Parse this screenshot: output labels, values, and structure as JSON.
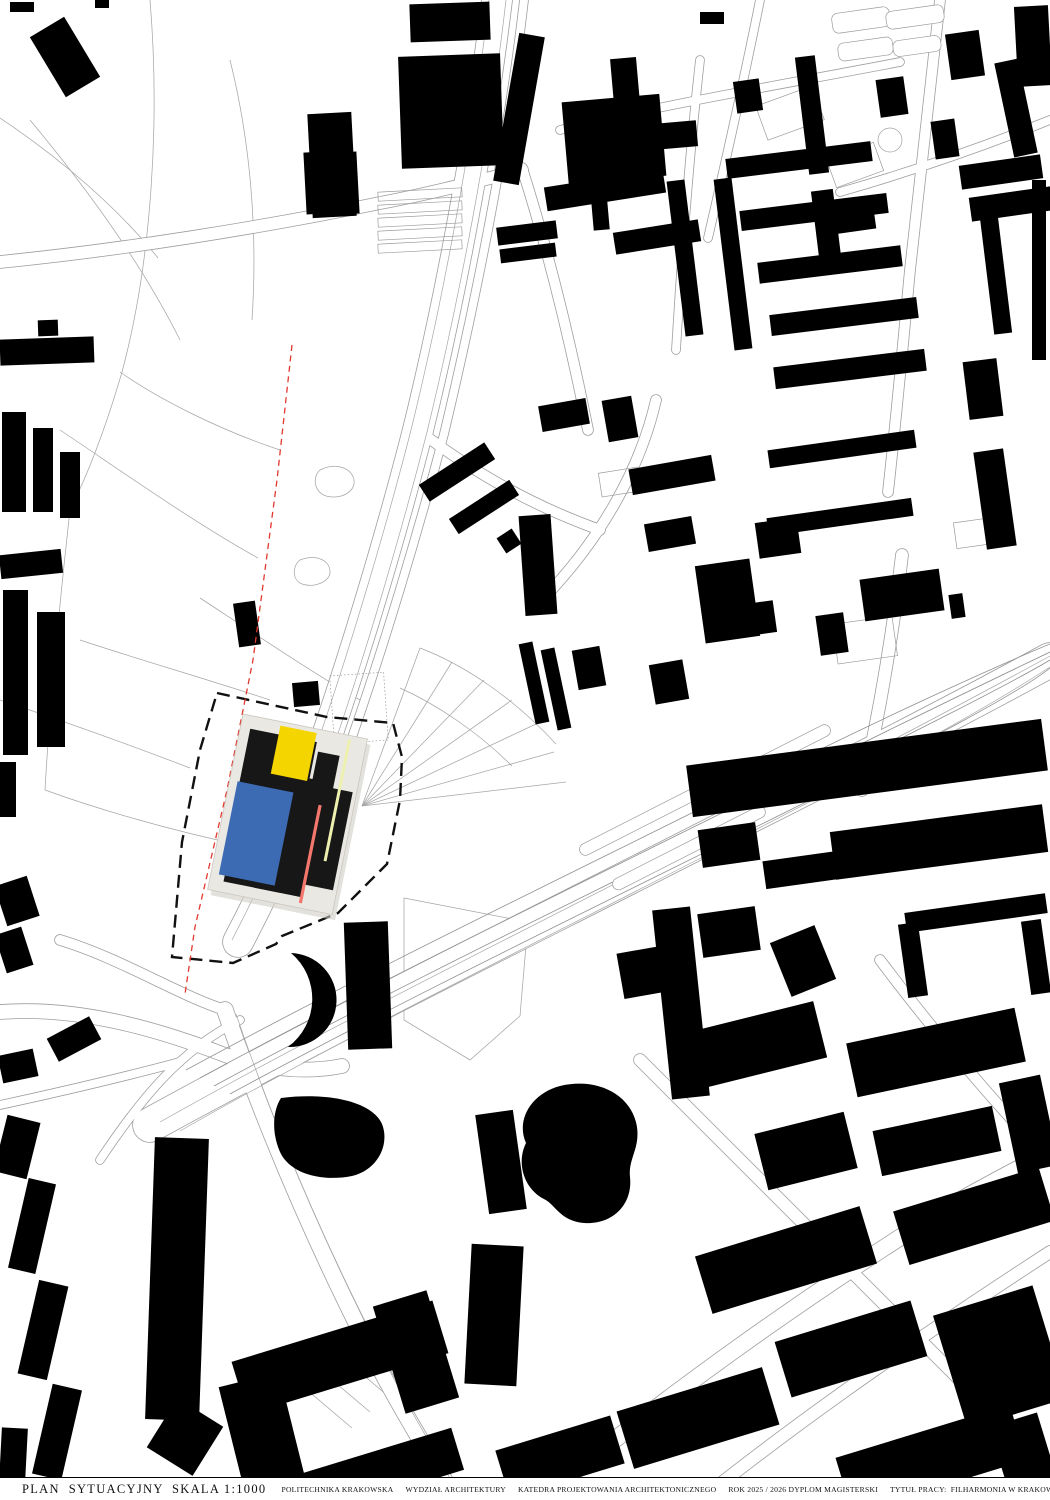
{
  "title_bar": {
    "title": "PLAN  SYTUACYJNY  SKALA 1:1000",
    "items": [
      "POLITECHNIKA KRAKOWSKA",
      "WYDZIAŁ ARCHITEKTURY",
      "KATEDRA PROJEKTOWANIA ARCHITEKTONICZNEGO",
      "ROK 2025 / 2026 DYPLOM MAGISTERSKI",
      "TYTUŁ PRACY:  FILHARMONIA W KRAKOWIE",
      "AUTOR: INŻ. ARCH. MONIKA SERAFIN",
      "PROMOTOR: DR INŻ. ARCH. PRZEMYSŁAW BIGAJ",
      "RECENZENT: DR INŻ. ARCH. JAN ŁAŚ, PROF. PK"
    ]
  },
  "colors": {
    "background": "#ffffff",
    "buildings": "#000000",
    "road_casing": "#9e9e9e",
    "road_fill": "#ffffff",
    "thin_line": "#a6a6a6",
    "rail_line": "#8f8f8f",
    "parcel_line": "#9a9a9a",
    "site_boundary": "#111111",
    "red_line": "#e2382f",
    "panel": "#eae8e2",
    "panel_edge": "#c9c7bf",
    "panel_shadow": "#cfcdc5",
    "black_mass": "#171717",
    "blue_block": "#3c6ab3",
    "yellow_block": "#f5d500",
    "pale_yellow_line": "#eef0b0",
    "salmon_line": "#f3776d"
  },
  "site": {
    "boundary": [
      [
        217,
        693
      ],
      [
        327,
        717
      ],
      [
        393,
        723
      ],
      [
        402,
        757
      ],
      [
        400,
        800
      ],
      [
        387,
        864
      ],
      [
        338,
        913
      ],
      [
        282,
        936
      ],
      [
        276,
        944
      ],
      [
        233,
        963
      ],
      [
        172,
        957
      ],
      [
        182,
        842
      ],
      [
        200,
        750
      ]
    ],
    "red_line": [
      [
        292,
        345
      ],
      [
        277,
        480
      ],
      [
        253,
        660
      ],
      [
        227,
        790
      ],
      [
        195,
        927
      ],
      [
        185,
        994
      ]
    ],
    "composition": {
      "origin": [
        243,
        714
      ],
      "rotation_deg": 11.4,
      "width": 127,
      "height": 179,
      "shapes": [
        {
          "name": "black-mass-upper",
          "x": 10,
          "y": 13,
          "w": 68,
          "h": 98,
          "fill": "black_mass"
        },
        {
          "name": "black-mass-right-top",
          "x": 81,
          "y": 22,
          "w": 22,
          "h": 50,
          "fill": "black_mass"
        },
        {
          "name": "black-mass-right",
          "x": 81,
          "y": 55,
          "w": 42,
          "h": 100,
          "fill": "black_mass"
        },
        {
          "name": "black-mass-center",
          "x": 45,
          "y": 50,
          "w": 48,
          "h": 118,
          "fill": "black_mass"
        },
        {
          "name": "black-mass-lower",
          "x": 14,
          "y": 138,
          "w": 58,
          "h": 30,
          "fill": "black_mass"
        },
        {
          "name": "blue-block",
          "x": 8,
          "y": 67,
          "w": 57,
          "h": 95,
          "fill": "blue_block"
        },
        {
          "name": "yellow-block",
          "x": 39,
          "y": 4,
          "w": 37,
          "h": 49,
          "fill": "yellow_block"
        },
        {
          "name": "pale-yellow-line",
          "x": 108,
          "y": 4,
          "w": 3,
          "h": 124,
          "fill": "pale_yellow_line"
        },
        {
          "name": "salmon-line",
          "x": 92,
          "y": 74,
          "w": 3.2,
          "h": 100,
          "fill": "salmon_line"
        }
      ]
    }
  },
  "map": {
    "roads": [
      {
        "d": "M497,0 C480,140 450,300 418,430 C395,520 360,640 322,750 C300,815 268,885 238,942",
        "w": 30
      },
      {
        "d": "M524,0 C508,140 476,300 444,434 C420,525 384,648 344,760",
        "w": 8
      },
      {
        "d": "M0,262 C120,250 260,228 380,203 C428,194 478,181 522,170",
        "w": 12
      },
      {
        "d": "M150,1125 C330,1026 530,928 710,836 C845,768 955,712 1050,660",
        "w": 34
      },
      {
        "d": "M225,1010 C258,1105 300,1208 350,1310 C390,1392 428,1452 456,1500",
        "w": 16
      },
      {
        "d": "M540,1500 C660,1400 800,1300 940,1212 C980,1188 1020,1168 1050,1152",
        "w": 16
      },
      {
        "d": "M700,1500 C810,1412 930,1330 1050,1252",
        "w": 12
      },
      {
        "d": "M640,1060 C760,1180 880,1300 1000,1420",
        "w": 12
      },
      {
        "d": "M880,960 C940,1040 1010,1120 1050,1160",
        "w": 10
      },
      {
        "d": "M902,555 C892,640 878,720 862,790",
        "w": 12
      },
      {
        "d": "M940,0 C930,90 920,180 910,270 C903,345 896,420 888,492",
        "w": 10
      },
      {
        "d": "M656,400 C640,470 600,540 542,600",
        "w": 10
      },
      {
        "d": "M522,168 C548,250 570,340 588,430",
        "w": 10
      },
      {
        "d": "M60,940 C120,958 180,996 225,1010",
        "w": 10
      },
      {
        "d": "M0,1012 C80,1006 160,1030 225,1055 C262,1068 302,1074 342,1066",
        "w": 14
      },
      {
        "d": "M100,1160 C140,1100 180,1050 240,1020",
        "w": 8
      },
      {
        "d": "M0,1105 C60,1092 120,1078 180,1062",
        "w": 8
      },
      {
        "d": "M700,60 C690,150 682,250 676,350",
        "w": 8
      },
      {
        "d": "M560,130 C660,105 780,85 900,62",
        "w": 8
      },
      {
        "d": "M1050,120 C980,148 910,172 840,192",
        "w": 8
      },
      {
        "d": "M760,0 C744,80 726,160 708,238",
        "w": 8
      },
      {
        "d": "M418,430 C470,470 530,505 600,530",
        "w": 10
      }
    ],
    "lane_lines": [
      "M489,0 C473,140 443,300 411,430 C388,520 353,640 315,750 C293,815 262,882 232,940",
      "M506,0 C490,140 459,300 427,432 C404,522 369,644 331,754",
      "M160,1122 C330,1026 530,928 710,835 C840,768 955,708 1050,656",
      "M180,1131 C350,1034 550,936 728,844 C862,775 975,716 1050,667",
      "M236,1014 C268,1108 310,1210 360,1312 C398,1392 436,1452 462,1500"
    ],
    "rails": [
      "M200,1078 C380,980 580,884 760,794 C900,724 1000,676 1050,652",
      "M214,1086 C394,988 594,892 774,802 C914,732 1010,684 1050,660",
      "M230,1094 C410,996 610,900 790,810 C930,740 1020,692 1050,668",
      "M186,1070 C366,972 566,876 746,786 C886,716 992,668 1050,644"
    ],
    "park_lines": [
      "M150,0 C160,120 152,260 122,372 C108,420 90,470 70,510",
      "M0,118 C60,158 118,208 158,258",
      "M60,430 C120,470 190,520 258,558",
      "M200,598 C258,636 318,676 360,700",
      "M0,700 C60,720 130,745 190,768",
      "M70,510 C60,600 50,700 45,790",
      "M120,372 C160,400 220,430 280,450",
      "M30,120 C80,180 140,260 180,340",
      "M230,60 C250,140 258,230 252,320",
      "M80,640 C140,660 210,680 270,700",
      "M45,790 C100,810 170,830 240,845",
      "M320,470 C336,462 352,468 354,480 C356,492 340,500 326,496 C314,492 312,477 320,470 Z",
      "M300,560 C316,554 330,560 330,572 C330,582 314,588 302,584 C292,580 292,566 300,560 Z",
      "M362,806 L420,648",
      "M362,806 L452,662",
      "M362,806 L484,680",
      "M362,806 L512,700",
      "M362,806 L536,724",
      "M362,806 L554,752",
      "M362,806 L566,782",
      "M420,648 C462,664 512,696 556,744",
      "M400,688 C436,704 478,732 512,766",
      "M319,802 A9,9 0 1 0 337,802 A9,9 0 1 0 319,802",
      "M878,140 A12,12 0 1 0 902,140 A12,12 0 1 0 878,140",
      "M404,898 L528,922 L520,1016 L470,1060 L404,1020 Z",
      "M300,1384 L352,1428",
      "M318,1368 L370,1412",
      "M336,1352 L388,1396"
    ],
    "parcels": [
      {
        "x": 332,
        "y": 674,
        "w": 54,
        "h": 68,
        "r": -4,
        "style": "dot"
      },
      {
        "x": 378,
        "y": 190,
        "w": 84,
        "h": 9,
        "r": -3
      },
      {
        "x": 378,
        "y": 203,
        "w": 84,
        "h": 9,
        "r": -3
      },
      {
        "x": 378,
        "y": 216,
        "w": 84,
        "h": 9,
        "r": -3
      },
      {
        "x": 378,
        "y": 229,
        "w": 84,
        "h": 9,
        "r": -3
      },
      {
        "x": 378,
        "y": 242,
        "w": 84,
        "h": 9,
        "r": -3
      },
      {
        "x": 760,
        "y": 95,
        "w": 60,
        "h": 36,
        "r": -20
      },
      {
        "x": 830,
        "y": 150,
        "w": 50,
        "h": 30,
        "r": -20
      },
      {
        "x": 600,
        "y": 470,
        "w": 40,
        "h": 24,
        "r": -9
      },
      {
        "x": 835,
        "y": 620,
        "w": 60,
        "h": 40,
        "r": -8
      },
      {
        "x": 955,
        "y": 520,
        "w": 40,
        "h": 26,
        "r": -8
      },
      {
        "x": 832,
        "y": 10,
        "w": 58,
        "h": 20,
        "r": -8,
        "style": "rx"
      },
      {
        "x": 838,
        "y": 40,
        "w": 55,
        "h": 18,
        "r": -8,
        "style": "rx"
      },
      {
        "x": 886,
        "y": 8,
        "w": 58,
        "h": 18,
        "r": -8,
        "style": "rx"
      },
      {
        "x": 893,
        "y": 38,
        "w": 48,
        "h": 16,
        "r": -8,
        "style": "rx"
      },
      {
        "x": 572,
        "y": 812,
        "w": 150,
        "h": 12,
        "r": -27,
        "style": "rx"
      },
      {
        "x": 688,
        "y": 756,
        "w": 150,
        "h": 12,
        "r": -27,
        "style": "rx"
      },
      {
        "x": 604,
        "y": 842,
        "w": 170,
        "h": 12,
        "r": -27,
        "style": "rx"
      }
    ],
    "buildings": [
      [
        45,
        22,
        40,
        70,
        -31
      ],
      [
        10,
        2,
        24,
        10,
        0
      ],
      [
        95,
        0,
        14,
        8,
        0
      ],
      [
        0,
        338,
        94,
        26,
        -2
      ],
      [
        38,
        320,
        20,
        16,
        -2
      ],
      [
        2,
        412,
        24,
        100,
        0
      ],
      [
        33,
        428,
        20,
        84,
        0
      ],
      [
        60,
        452,
        20,
        66,
        0
      ],
      [
        0,
        552,
        62,
        24,
        -6
      ],
      [
        3,
        590,
        25,
        165,
        0
      ],
      [
        37,
        612,
        28,
        135,
        0
      ],
      [
        0,
        762,
        16,
        55,
        0
      ],
      [
        0,
        880,
        34,
        42,
        -18
      ],
      [
        0,
        930,
        28,
        40,
        -18
      ],
      [
        50,
        1026,
        48,
        26,
        -28
      ],
      [
        0,
        1052,
        36,
        28,
        -12
      ],
      [
        0,
        1118,
        34,
        58,
        14
      ],
      [
        236,
        602,
        22,
        44,
        -8
      ],
      [
        310,
        113,
        44,
        104,
        -3
      ],
      [
        305,
        152,
        20,
        62,
        -3
      ],
      [
        338,
        152,
        20,
        62,
        -3
      ],
      [
        410,
        3,
        80,
        38,
        -2
      ],
      [
        400,
        55,
        102,
        112,
        -2
      ],
      [
        506,
        34,
        26,
        150,
        10
      ],
      [
        565,
        98,
        98,
        82,
        -5
      ],
      [
        655,
        122,
        42,
        26,
        -5
      ],
      [
        612,
        58,
        26,
        46,
        -5
      ],
      [
        592,
        190,
        16,
        40,
        -5
      ],
      [
        497,
        224,
        60,
        18,
        -7
      ],
      [
        500,
        246,
        56,
        14,
        -7
      ],
      [
        700,
        12,
        24,
        12,
        0
      ],
      [
        735,
        80,
        26,
        32,
        -8
      ],
      [
        802,
        56,
        20,
        118,
        -7
      ],
      [
        815,
        190,
        22,
        68,
        -7
      ],
      [
        825,
        210,
        50,
        22,
        -8
      ],
      [
        878,
        78,
        28,
        38,
        -8
      ],
      [
        948,
        32,
        34,
        46,
        -8
      ],
      [
        933,
        120,
        24,
        38,
        -8
      ],
      [
        960,
        160,
        82,
        24,
        -8
      ],
      [
        970,
        192,
        82,
        24,
        -8
      ],
      [
        1004,
        60,
        24,
        96,
        -12
      ],
      [
        1016,
        6,
        34,
        80,
        -3
      ],
      [
        1032,
        180,
        14,
        180,
        0
      ],
      [
        676,
        180,
        18,
        156,
        -7
      ],
      [
        724,
        178,
        18,
        172,
        -7
      ],
      [
        726,
        150,
        146,
        20,
        -7
      ],
      [
        740,
        202,
        148,
        20,
        -7
      ],
      [
        758,
        254,
        144,
        21,
        -7
      ],
      [
        770,
        306,
        148,
        21,
        -7
      ],
      [
        774,
        358,
        152,
        22,
        -7
      ],
      [
        545,
        178,
        120,
        24,
        -9
      ],
      [
        614,
        226,
        86,
        22,
        -9
      ],
      [
        987,
        216,
        18,
        118,
        -7
      ],
      [
        966,
        360,
        34,
        58,
        -7
      ],
      [
        768,
        440,
        148,
        18,
        -8
      ],
      [
        767,
        508,
        146,
        18,
        -8
      ],
      [
        862,
        574,
        80,
        42,
        -8
      ],
      [
        980,
        450,
        30,
        98,
        -8
      ],
      [
        950,
        594,
        14,
        24,
        -8
      ],
      [
        818,
        614,
        28,
        40,
        -8
      ],
      [
        747,
        602,
        28,
        32,
        -8
      ],
      [
        540,
        402,
        48,
        26,
        -10
      ],
      [
        605,
        398,
        30,
        42,
        -10
      ],
      [
        630,
        462,
        84,
        26,
        -10
      ],
      [
        646,
        520,
        48,
        28,
        -10
      ],
      [
        522,
        515,
        32,
        100,
        -4
      ],
      [
        418,
        462,
        78,
        20,
        -33
      ],
      [
        448,
        498,
        72,
        18,
        -33
      ],
      [
        500,
        532,
        18,
        18,
        -33
      ],
      [
        575,
        648,
        28,
        40,
        -10
      ],
      [
        652,
        662,
        34,
        40,
        -10
      ],
      [
        700,
        562,
        55,
        78,
        -8
      ],
      [
        757,
        520,
        42,
        36,
        -8
      ],
      [
        527,
        642,
        14,
        82,
        -12
      ],
      [
        549,
        648,
        14,
        82,
        -12
      ],
      [
        293,
        682,
        26,
        24,
        -5
      ],
      [
        688,
        742,
        358,
        52,
        -7.5
      ],
      [
        832,
        818,
        214,
        48,
        -7.5
      ],
      [
        700,
        826,
        58,
        38,
        -8
      ],
      [
        764,
        856,
        76,
        28,
        -8
      ],
      [
        905,
        903,
        142,
        20,
        -8
      ],
      [
        903,
        923,
        20,
        74,
        -8
      ],
      [
        1026,
        920,
        20,
        74,
        -8
      ],
      [
        700,
        910,
        58,
        44,
        -8
      ],
      [
        779,
        932,
        48,
        58,
        -22
      ],
      [
        620,
        948,
        62,
        46,
        -10
      ],
      [
        662,
        908,
        38,
        190,
        -6
      ],
      [
        482,
        1112,
        38,
        100,
        -8
      ],
      [
        468,
        1245,
        52,
        140,
        3
      ],
      [
        700,
        1015,
        122,
        58,
        -14
      ],
      [
        850,
        1025,
        172,
        55,
        -12
      ],
      [
        1008,
        1078,
        42,
        92,
        -12
      ],
      [
        876,
        1118,
        122,
        46,
        -12
      ],
      [
        760,
        1122,
        92,
        58,
        -14
      ],
      [
        700,
        1230,
        172,
        60,
        -17
      ],
      [
        898,
        1188,
        152,
        56,
        -17
      ],
      [
        948,
        1298,
        104,
        118,
        -17
      ],
      [
        780,
        1320,
        142,
        58,
        -17
      ],
      [
        622,
        1388,
        152,
        60,
        -17
      ],
      [
        840,
        1430,
        182,
        58,
        -17
      ],
      [
        1000,
        1418,
        50,
        82,
        -17
      ],
      [
        500,
        1432,
        120,
        50,
        -17
      ],
      [
        150,
        1138,
        54,
        282,
        2
      ],
      [
        158,
        1408,
        54,
        58,
        32
      ],
      [
        18,
        1180,
        28,
        92,
        13
      ],
      [
        28,
        1282,
        30,
        96,
        13
      ],
      [
        42,
        1386,
        30,
        92,
        13
      ],
      [
        0,
        1428,
        26,
        72,
        3
      ],
      [
        235,
        1330,
        210,
        55,
        -17
      ],
      [
        232,
        1378,
        62,
        118,
        -14
      ],
      [
        388,
        1296,
        56,
        112,
        -17
      ],
      [
        262,
        1456,
        200,
        44,
        -17
      ],
      [
        346,
        922,
        44,
        127,
        -2
      ]
    ],
    "building_paths": [
      "M291,953 A47,47 0 1 1 288,1047 A60,60 0 0 0 291,953 Z",
      "M281,1098 C330,1092 372,1102 382,1124 C390,1144 378,1170 352,1176 C322,1182 290,1174 280,1152 C272,1134 272,1112 281,1098 Z",
      "M560,1086 C598,1077 632,1095 637,1127 C640,1149 628,1159 630,1177 C633,1205 612,1225 584,1223 C560,1221 556,1205 544,1199 C524,1189 516,1163 526,1143 C516,1121 530,1094 560,1086 Z"
    ]
  }
}
